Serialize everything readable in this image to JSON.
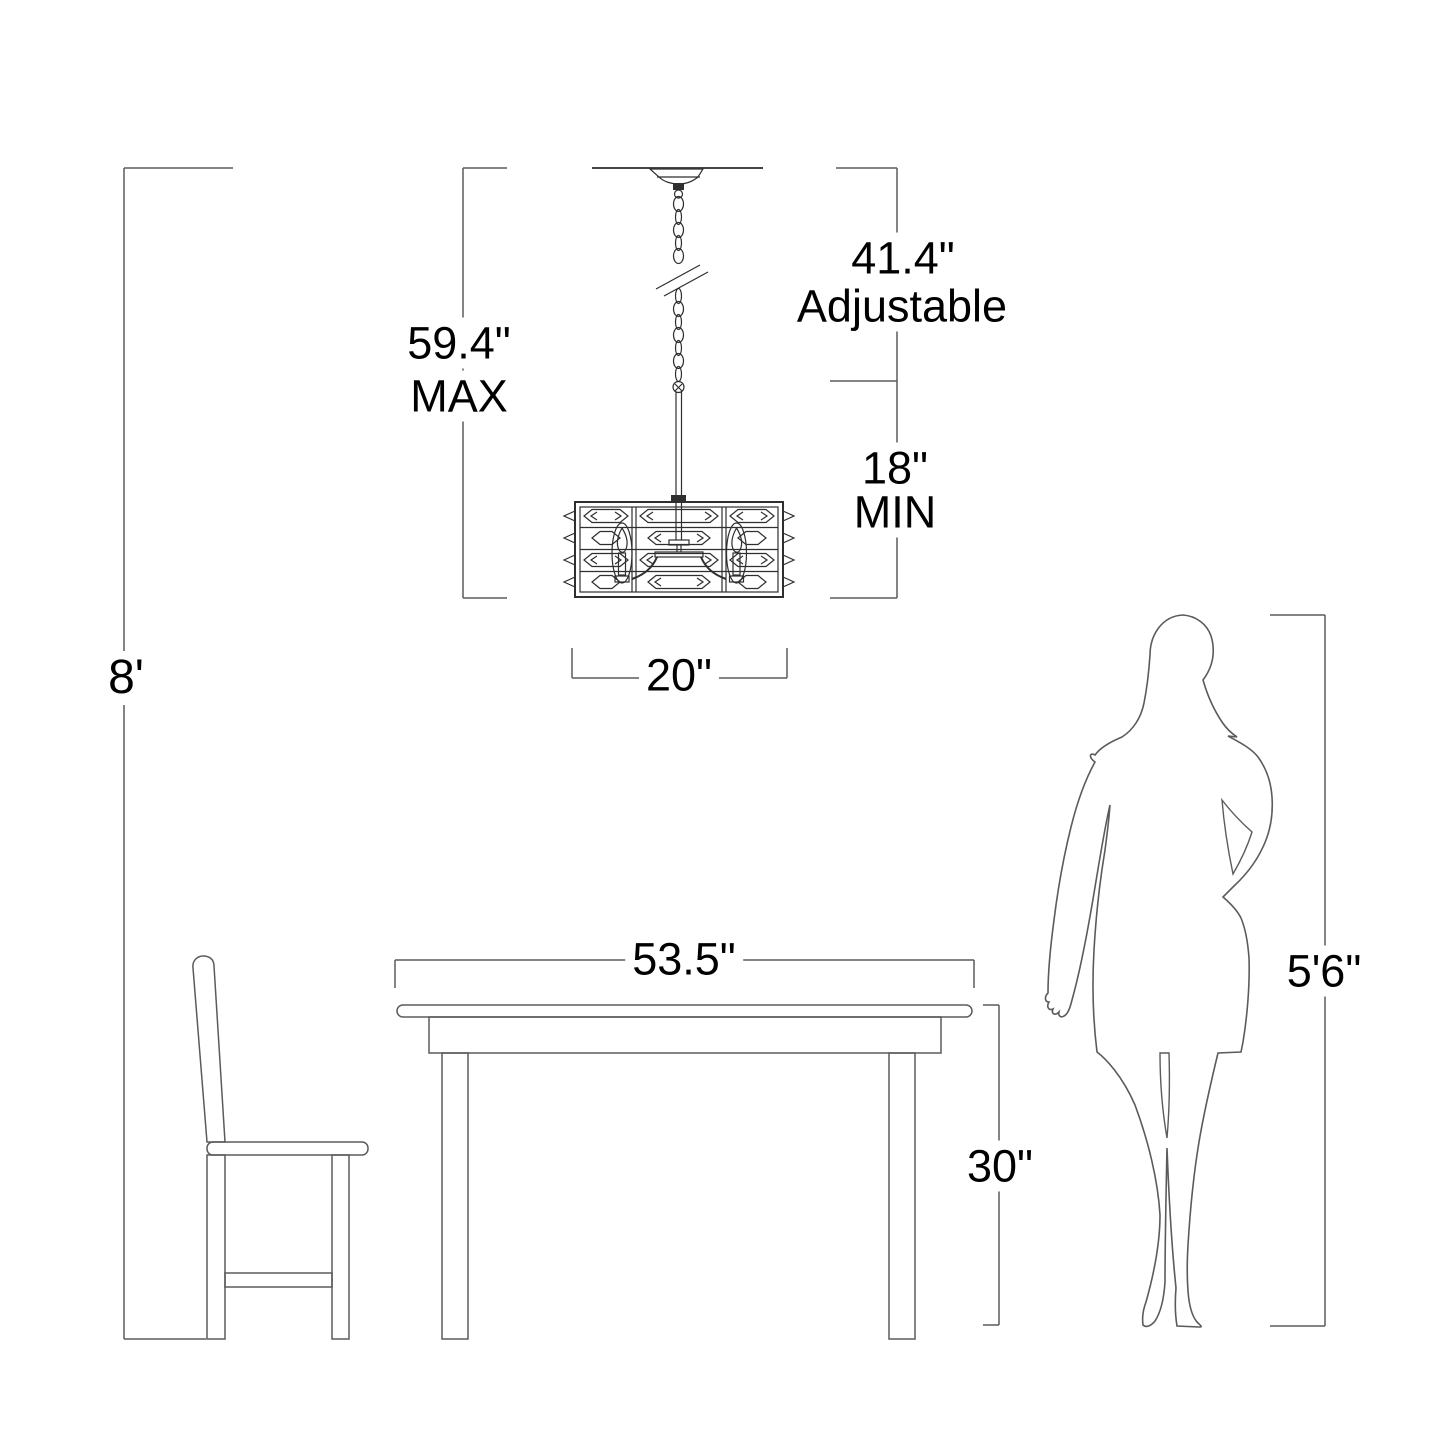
{
  "figure": {
    "kind": "product installation dimension diagram",
    "objects": [
      "ceiling-line",
      "canopy",
      "hanging-chain",
      "chain-break-mark",
      "hang-rod",
      "crystal-chandelier-fixture",
      "candle-lamp-left",
      "candle-lamp-right",
      "dining-table",
      "side-chair",
      "person-silhouette"
    ]
  },
  "labels": {
    "ceiling_height": "8'",
    "max_overall": {
      "value": "59.4\"",
      "qualifier": "MAX"
    },
    "adjustable_range": {
      "value": "41.4\"",
      "qualifier": "Adjustable"
    },
    "min_drop": {
      "value": "18\"",
      "qualifier": "MIN"
    },
    "fixture_width": "20\"",
    "table_width": "53.5\"",
    "table_height": "30\"",
    "person_height": "5'6\""
  },
  "colors": {
    "background": "#ffffff",
    "line": "#5b5b5b",
    "fixture_line": "#2f2f2f",
    "text": "#000000"
  }
}
